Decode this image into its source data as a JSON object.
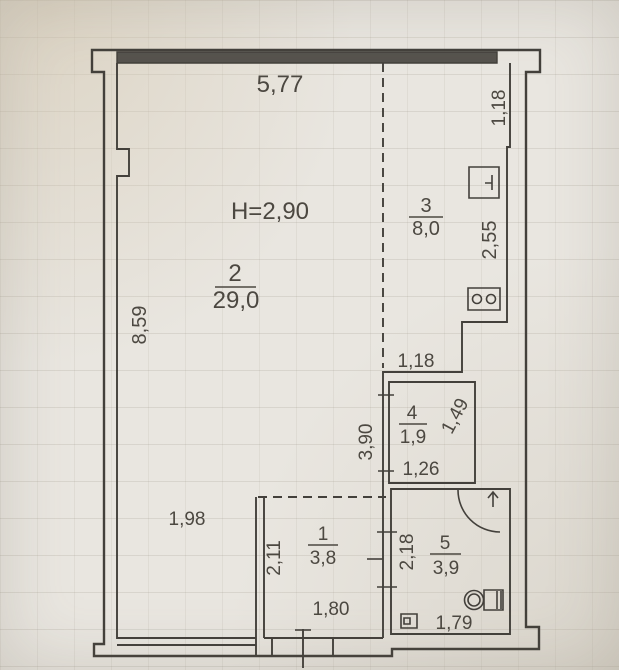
{
  "plan": {
    "ceiling_height_label": "H=2,90",
    "rooms": [
      {
        "number": "1",
        "area": "3,8"
      },
      {
        "number": "2",
        "area": "29,0"
      },
      {
        "number": "3",
        "area": "8,0"
      },
      {
        "number": "4",
        "area": "1,9"
      },
      {
        "number": "5",
        "area": "3,9"
      }
    ],
    "dimensions": {
      "top_width": "5,77",
      "right_bay_height": "1,18",
      "kitchen_right": "2,55",
      "left_height": "8,59",
      "kitchen_bottom": "1,18",
      "storage_left": "3,90",
      "storage_right": "1,49",
      "storage_bottom": "1,26",
      "hall_offset_left": "1,98",
      "hall_left": "2,11",
      "hall_bottom": "1,80",
      "bath_left": "2,18",
      "bath_bottom": "1,79"
    },
    "fixtures": [
      "sink",
      "stove",
      "toilet",
      "floor-drain",
      "door-swing-arc",
      "entrance-arrow",
      "entrance-door"
    ],
    "colors": {
      "ink": "#43403b",
      "wall_fill": "#56534e",
      "paper": "#e9e6e0",
      "text": "#4c4841"
    }
  }
}
